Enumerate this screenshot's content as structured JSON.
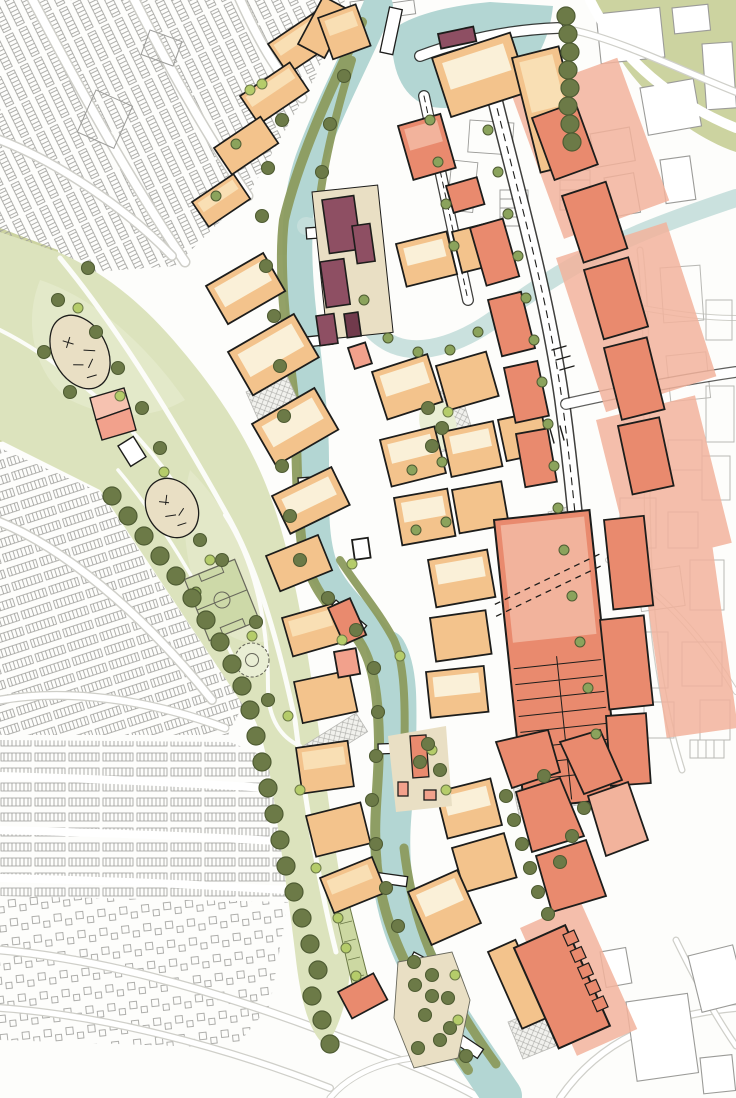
{
  "map": {
    "kind": "illustrated-urban-masterplan",
    "canvas": {
      "width": 736,
      "height": 1098
    },
    "colors": {
      "paper": "#fdfdfb",
      "ink": "#1d1d1b",
      "outlineGray": "#9b9b98",
      "fadedGray": "#b9b9b5",
      "roadCase": "#cfcfc9",
      "white": "#ffffff",
      "oliveBand": "#ccd3a0",
      "parkGreen": "#dce3bd",
      "parkLight": "#e9eed4",
      "pitchGreen": "#cdd9a8",
      "pitchLine": "#68685c",
      "bankGreen": "#8d9c5f",
      "treeDark": "#6c7a47",
      "treeDarkStroke": "#4f5c33",
      "treeMid": "#8ba35c",
      "treeLime": "#b5cc6a",
      "water": "#b3d6d3",
      "waterLight": "#c6dedb",
      "peach": "#f3c38c",
      "peachLight": "#f9dfb4",
      "cream": "#faf0d8",
      "salmon": "#e98a6e",
      "salmonLight": "#f2b39c",
      "pink": "#f2a18c",
      "pinkLight": "#f6c2b0",
      "plum": "#8e4f63",
      "plumDark": "#713a4c",
      "beige": "#e9dfc4",
      "hatchLine": "#a8a8a4",
      "hatchBg": "#f1f1ed",
      "wetland": "#ccd8a2"
    },
    "layers": [
      {
        "name": "existing-terraced-housing",
        "style_key": "outlineGray"
      },
      {
        "name": "existing-suburban-housing",
        "style_key": "outlineGray"
      },
      {
        "name": "existing-industrial-buildings",
        "style_key": "outlineGray"
      },
      {
        "name": "linear-park",
        "style_key": "parkGreen"
      },
      {
        "name": "river-corridor",
        "style_key": "water"
      },
      {
        "name": "canal-arm",
        "style_key": "waterLight"
      },
      {
        "name": "riparian-tree-belt",
        "style_key": "treeDark"
      },
      {
        "name": "proposed-residential-blocks",
        "style_key": "peach"
      },
      {
        "name": "proposed-mixed-use-blocks",
        "style_key": "salmon"
      },
      {
        "name": "landmark-buildings",
        "style_key": "plum"
      },
      {
        "name": "accent-buildings",
        "style_key": "pink"
      },
      {
        "name": "paved-plazas",
        "style_key": "hatchBg"
      },
      {
        "name": "sports-pitch",
        "style_key": "pitchGreen"
      },
      {
        "name": "playgrounds",
        "style_key": "beige"
      },
      {
        "name": "street-trees",
        "style_key": "treeMid"
      }
    ]
  }
}
